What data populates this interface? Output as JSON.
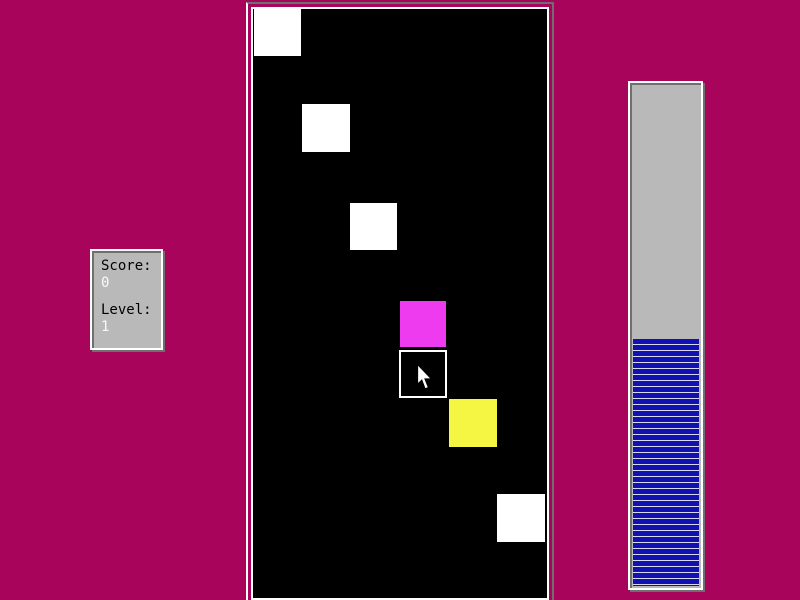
{
  "app": {
    "name": "falling-blocks-game-screen"
  },
  "colors": {
    "background": "#A8045C",
    "panel_face": "#B9B9B9",
    "panel_highlight": "#FFFFFF",
    "panel_shadow": "#6F6F6F",
    "field_background": "#000000",
    "label_text": "#000000",
    "value_text": "#FAFAFA"
  },
  "score_panel": {
    "score_label": "Score:",
    "score_value": "0",
    "level_label": "Level:",
    "level_value": "1"
  },
  "game_field": {
    "background": "#000000",
    "squares": [
      {
        "x": 1,
        "y": 0,
        "size": 47,
        "color": "#FFFFFF",
        "type": "solid"
      },
      {
        "x": 49,
        "y": 95,
        "size": 48,
        "color": "#FFFFFF",
        "type": "solid"
      },
      {
        "x": 97,
        "y": 194,
        "size": 47,
        "color": "#FFFFFF",
        "type": "solid"
      },
      {
        "x": 147,
        "y": 292,
        "size": 46,
        "color": "#EE3BEF",
        "type": "solid"
      },
      {
        "x": 146,
        "y": 341,
        "size": 48,
        "color": "#000000",
        "type": "outline",
        "border_color": "#FFFFFF"
      },
      {
        "x": 196,
        "y": 390,
        "size": 48,
        "color": "#F5F543",
        "type": "solid"
      },
      {
        "x": 244,
        "y": 485,
        "size": 48,
        "color": "#FFFFFF",
        "type": "solid"
      }
    ],
    "cursor": {
      "x": 164,
      "y": 355
    }
  },
  "level_meter": {
    "fill_percent": 49,
    "fill_color": "#1111AF",
    "stripe_gap_color": "#D8D8F0",
    "stripe_height_px": 5,
    "stripe_gap_px": 1,
    "track_color": "#B9B9B9"
  }
}
